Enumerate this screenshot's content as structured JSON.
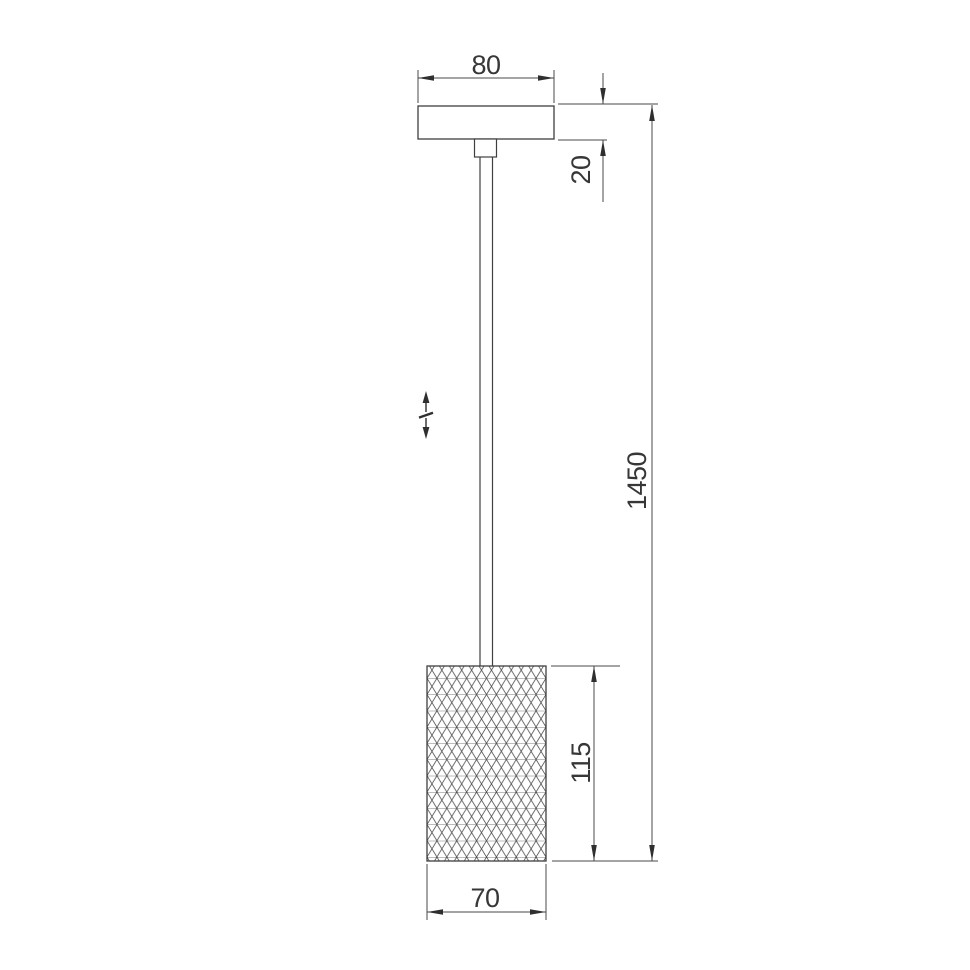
{
  "drawing": {
    "type": "technical-dimension-drawing",
    "subject": "pendant-lamp",
    "dimensions": {
      "canopy_width": "80",
      "canopy_thickness": "20",
      "overall_drop": "1450",
      "shade_height": "115",
      "shade_width": "70"
    },
    "icons": {
      "adjustment": "height-adjustment-double-arrow-icon"
    },
    "colors": {
      "background": "#ffffff",
      "object_line": "#3f3f3f",
      "dimension_line": "#4a4a4a",
      "pattern_line": "#4d4d4d",
      "text": "#373737"
    }
  }
}
